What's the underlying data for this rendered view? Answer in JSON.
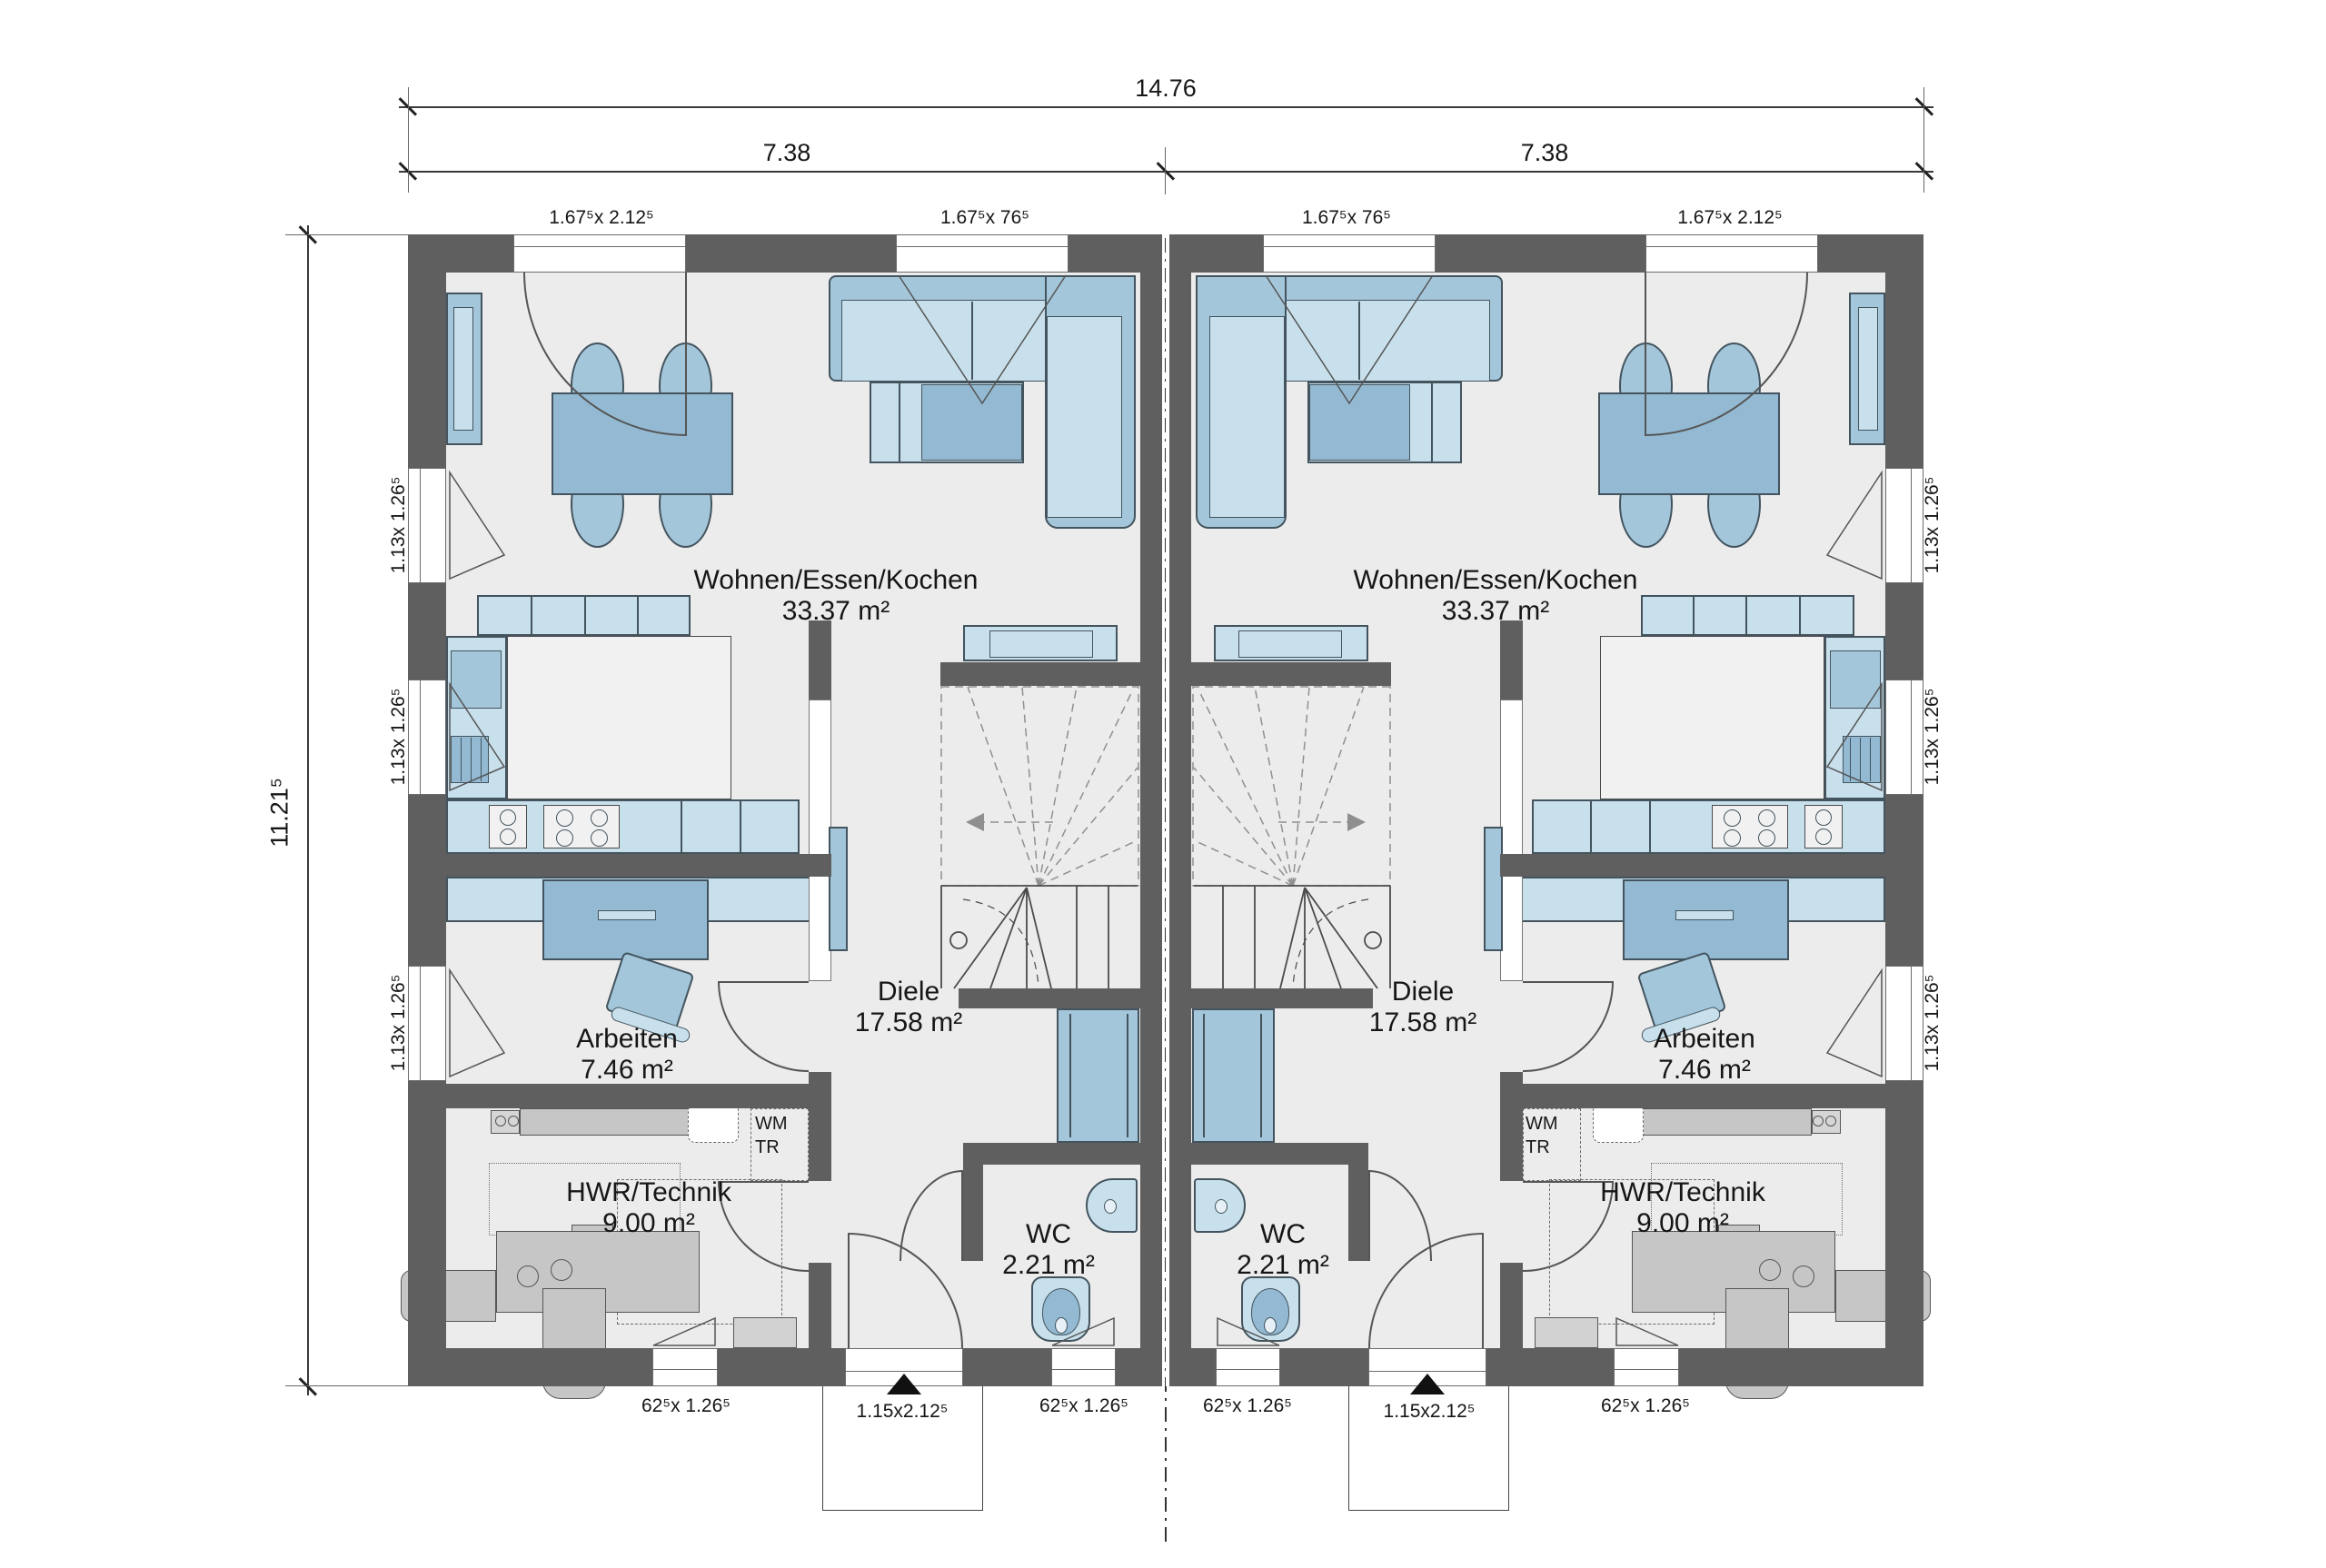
{
  "palette": {
    "wall": "#5f5f5f",
    "floor": "#ececec",
    "furniture_blue": "#a3c6da",
    "furniture_blue_light": "#c8e0ec",
    "furniture_blue_dark": "#93bad2",
    "equipment_gray": "#c6c6c6",
    "line": "#333333"
  },
  "dimensions": {
    "total_width": "14.76",
    "left_width": "7.38",
    "right_width": "7.38",
    "total_depth": "11.21⁵"
  },
  "window_labels": {
    "terrace_door": "1.67⁵x 2.12⁵",
    "fixed_window": "1.67⁵x 76⁵",
    "side_window": "1.13x 1.26⁵",
    "small_window": "62⁵x 1.26⁵",
    "entry_door": "1.15x2.12⁵"
  },
  "units": [
    {
      "side": "left",
      "rooms": {
        "living": {
          "name": "Wohnen/Essen/Kochen",
          "area": "33.37 m²"
        },
        "hall": {
          "name": "Diele",
          "area": "17.58 m²"
        },
        "office": {
          "name": "Arbeiten",
          "area": "7.46 m²"
        },
        "utility": {
          "name": "HWR/Technik",
          "area": "9.00 m²",
          "wm": "WM",
          "tr": "TR"
        },
        "wc": {
          "name": "WC",
          "area": "2.21 m²"
        }
      }
    },
    {
      "side": "right",
      "rooms": {
        "living": {
          "name": "Wohnen/Essen/Kochen",
          "area": "33.37 m²"
        },
        "hall": {
          "name": "Diele",
          "area": "17.58 m²"
        },
        "office": {
          "name": "Arbeiten",
          "area": "7.46 m²"
        },
        "utility": {
          "name": "HWR/Technik",
          "area": "9.00 m²",
          "wm": "WM",
          "tr": "TR"
        },
        "wc": {
          "name": "WC",
          "area": "2.21 m²"
        }
      }
    }
  ]
}
